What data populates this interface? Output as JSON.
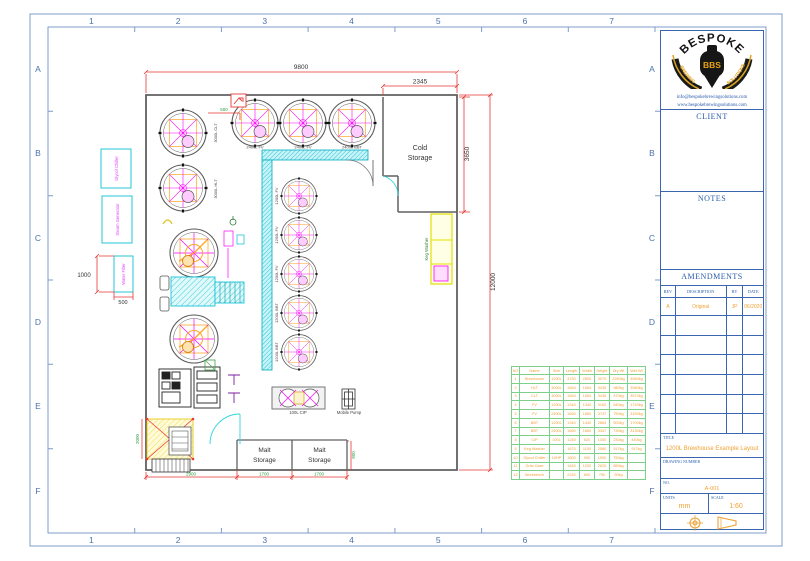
{
  "frame": {
    "grid_numbers": [
      "1",
      "2",
      "3",
      "4",
      "5",
      "6",
      "7"
    ],
    "grid_letters": [
      "A",
      "B",
      "C",
      "D",
      "E",
      "F"
    ]
  },
  "title_block": {
    "logo": {
      "brand_top": "BESPOKE",
      "brand_center": "BBS",
      "ribbon_left": "BREWING",
      "ribbon_right": "SOLUTIONS",
      "email": "info@bespokebrewingsolutions.com",
      "website": "www.bespokebrewingsolutions.com"
    },
    "client_label": "CLIENT",
    "notes_label": "NOTES",
    "amendments": {
      "heading": "AMENDMENTS",
      "columns": [
        "REV",
        "DESCRIPTION",
        "BY",
        "DATE"
      ],
      "rows": [
        {
          "rev": "A",
          "description": "Original",
          "by": "JP",
          "date": "06/2020"
        }
      ]
    },
    "title_label": "TITLE",
    "title_value": "1200L Brewhouse Example Layout",
    "drawing_number_label": "DRAWING NUMBER",
    "no_label": "NO.",
    "no_value": "A-001",
    "units_label": "UNITS",
    "units_value": "mm",
    "scale_label": "SCALE",
    "scale_value": "1:60"
  },
  "plan": {
    "rooms": {
      "cold_line1": "Cold",
      "cold_line2": "Storage",
      "malt_line1": "Malt",
      "malt_line2": "Storage"
    },
    "tanks": {
      "clt": "3000L CLT",
      "hlt": "3000L HLT",
      "fv2400_a": "2400L FV",
      "fv2400_b": "2400L FV",
      "bbt2400": "2400L BBT",
      "fv1200_a": "1200L FV",
      "fv1200_b": "1200L FV",
      "fv1200_c": "1200L FV",
      "bbt1200_a": "1200L BBT",
      "bbt1200_b": "1200L BBT"
    },
    "equipment": {
      "glycol_chiller": "Glycol Chiller",
      "steam_generator": "Steam Generator",
      "water_filter": "Water Filter",
      "keg_washer": "Keg Washer",
      "cip": "100L CIP",
      "mobile_pump": "Mobile Pump"
    },
    "dimensions": {
      "overall_width": "9800",
      "cold_width": "2345",
      "cold_height": "3650",
      "overall_height": "12000",
      "filter_height": "1000",
      "filter_width": "500",
      "pipe_offset": "500",
      "bottom_left": "2900",
      "malt_left": "1700",
      "malt_right": "1700",
      "malt_height": "800",
      "left_lower": "2000"
    }
  },
  "parts_table": {
    "columns": [
      "NO",
      "Name",
      "Size",
      "Length",
      "Width",
      "Height",
      "Dry Wt",
      "Wet Wt"
    ],
    "rows": [
      [
        "1",
        "Brewhouse",
        "1200L",
        "4750",
        "2500",
        "3070",
        "2260kg",
        "4560kg"
      ],
      [
        "2",
        "HLT",
        "3000L",
        "1564",
        "1564",
        "3435",
        "980kg",
        "3980kg"
      ],
      [
        "3",
        "CLT",
        "3000L",
        "1564",
        "1564",
        "3435",
        "570kg",
        "3570kg"
      ],
      [
        "4",
        "FV",
        "1200L",
        "1340",
        "1340",
        "3162",
        "540kg",
        "1740kg"
      ],
      [
        "5",
        "FV",
        "2400L",
        "1660",
        "1660",
        "3747",
        "750kg",
        "3150kg"
      ],
      [
        "6",
        "BBT",
        "1200L",
        "1340",
        "1340",
        "2864",
        "500kg",
        "1700kg"
      ],
      [
        "7",
        "BBT",
        "2400L",
        "1660",
        "1660",
        "3347",
        "730kg",
        "3130kg"
      ],
      [
        "8",
        "CIP",
        "100L",
        "1240",
        "620",
        "1300",
        "230kg",
        "440kg"
      ],
      [
        "9",
        "Keg Washer",
        "",
        "1670",
        "1100",
        "2580",
        "917kg",
        "917kg"
      ],
      [
        "10",
        "Glycol Chiller",
        "10HP",
        "1800",
        "900",
        "1900",
        "750kg",
        ""
      ],
      [
        "11",
        "Grist Case",
        "",
        "1840",
        "1200",
        "2620",
        "850kg",
        ""
      ],
      [
        "12",
        "Workbench",
        "",
        "2240",
        "800",
        "750",
        "90kg",
        ""
      ]
    ]
  },
  "colors": {
    "frame_blue": "#7e9cc8",
    "label_blue": "#2a5caa",
    "value_orange": "#f0a235",
    "wall_gray": "#606060",
    "tank_magenta": "#ff00ff",
    "detail_orange": "#ffa726",
    "cold_wall_cyan": "#26c6da",
    "dim_red": "#e53935",
    "dim_green": "#2e9e3f",
    "table_green": "#7ecf8a"
  }
}
